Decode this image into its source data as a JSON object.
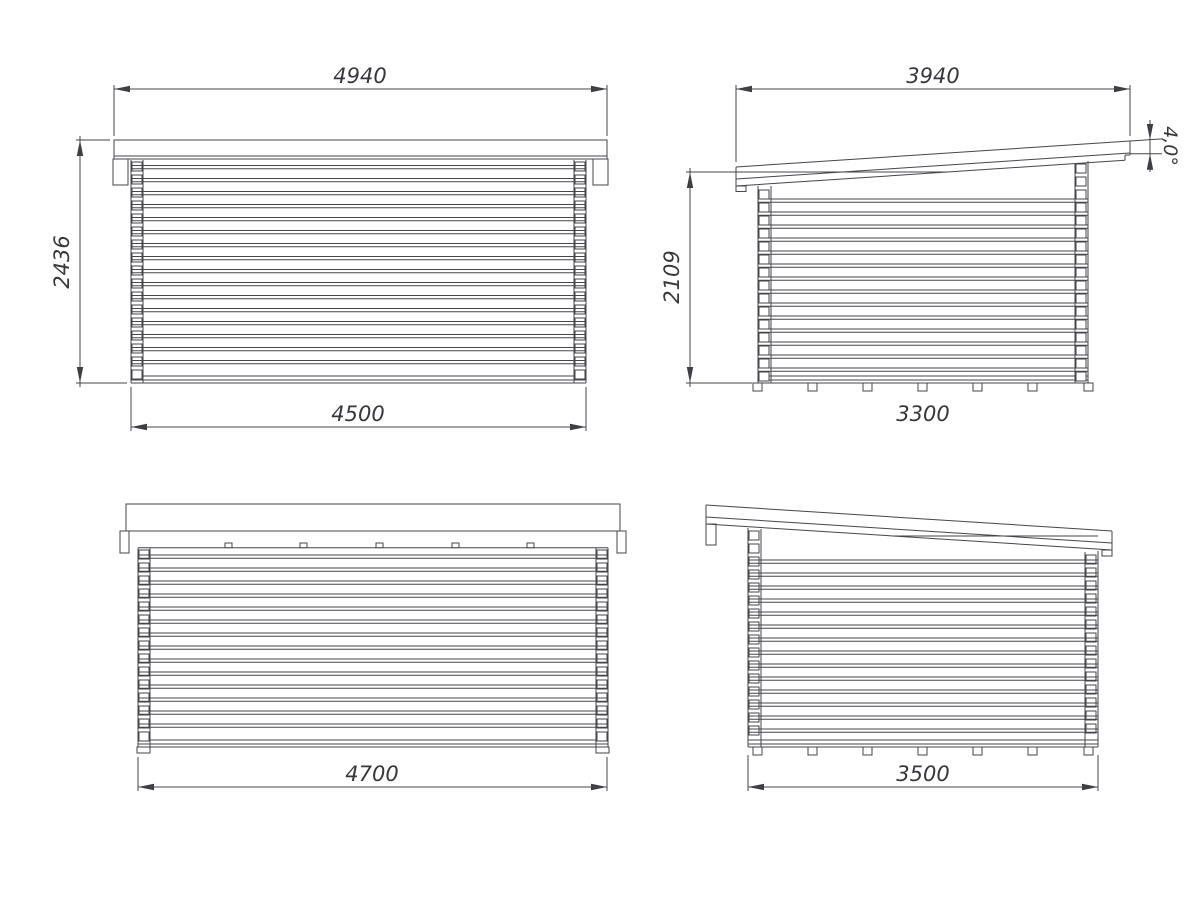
{
  "drawing": {
    "background": "#ffffff",
    "line_color": "#45454b",
    "text_color": "#38383c",
    "views": {
      "front_elevation": {
        "dim_roof_width": "4940",
        "dim_height": "2436",
        "dim_wall_width": "4500"
      },
      "side_elevation_right": {
        "dim_roof_depth": "3940",
        "dim_height": "2109",
        "dim_wall_depth": "3300",
        "dim_roof_angle": "4,0°"
      },
      "rear_elevation": {
        "dim_wall_width": "4700"
      },
      "side_elevation_left": {
        "dim_wall_depth": "3500"
      }
    }
  }
}
